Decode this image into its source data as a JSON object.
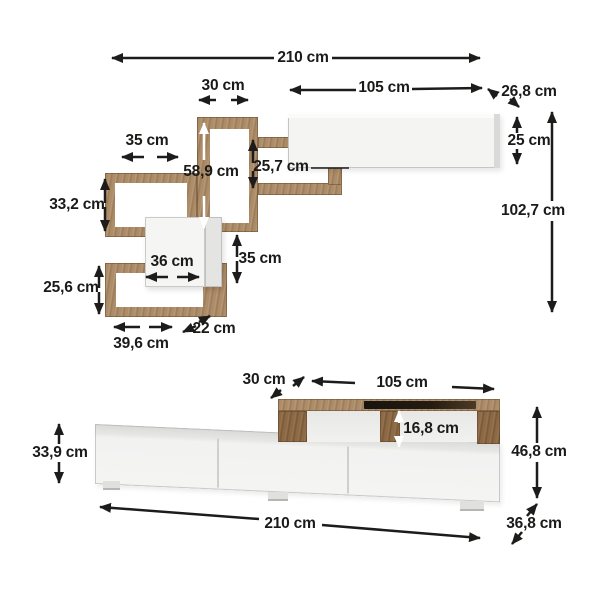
{
  "diagram": {
    "type": "furniture-dimension-drawing",
    "unit": "cm",
    "background": "#ffffff",
    "colors": {
      "wood": "#ad8c68",
      "wood_dark": "#8d6a45",
      "panel_white": "#f4f4f3",
      "panel_side": "#e2e2e0",
      "cabinet_top_gray": "#d9d9d7",
      "glass_black": "#17130e",
      "dimension_line": "#1d1c1a",
      "text": "#1a1a19"
    },
    "wall_unit": {
      "name": "wall shelf unit",
      "dims": {
        "total_width": "210 cm",
        "column_width": "30 cm",
        "cabinet_width": "105 cm",
        "cabinet_depth": "26,8 cm",
        "cabinet_height": "25 cm",
        "total_height": "102,7 cm",
        "upper_box_width": "35 cm",
        "column_height": "58,9 cm",
        "shelf_gap": "25,7 cm",
        "upper_box_height": "33,2 cm",
        "cube_width": "36 cm",
        "cube_height": "35 cm",
        "lower_box_height": "25,6 cm",
        "lower_box_width": "39,6 cm",
        "shelf_depth": "22 cm"
      }
    },
    "tv_stand": {
      "name": "tv stand",
      "dims": {
        "riser_depth": "30 cm",
        "riser_width": "105 cm",
        "riser_opening_height": "16,8 cm",
        "cabinet_height": "33,9 cm",
        "total_height": "46,8 cm",
        "total_width": "210 cm",
        "total_depth": "36,8 cm"
      }
    }
  }
}
